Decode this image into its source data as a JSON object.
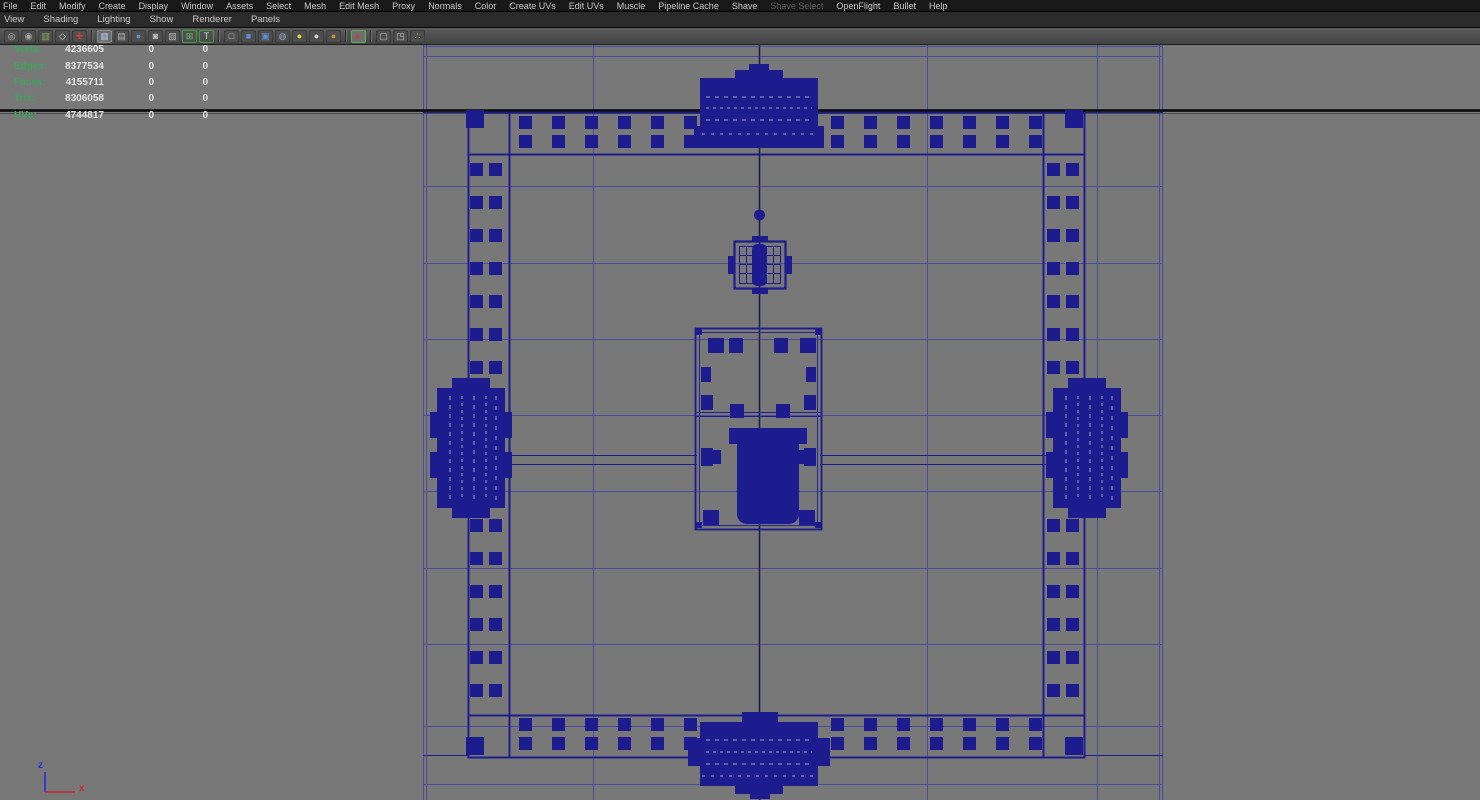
{
  "menu_bar": {
    "items": [
      {
        "label": "File",
        "enabled": true
      },
      {
        "label": "Edit",
        "enabled": true
      },
      {
        "label": "Modify",
        "enabled": true
      },
      {
        "label": "Create",
        "enabled": true
      },
      {
        "label": "Display",
        "enabled": true
      },
      {
        "label": "Window",
        "enabled": true
      },
      {
        "label": "Assets",
        "enabled": true
      },
      {
        "label": "Select",
        "enabled": true
      },
      {
        "label": "Mesh",
        "enabled": true
      },
      {
        "label": "Edit Mesh",
        "enabled": true
      },
      {
        "label": "Proxy",
        "enabled": true
      },
      {
        "label": "Normals",
        "enabled": true
      },
      {
        "label": "Color",
        "enabled": true
      },
      {
        "label": "Create UVs",
        "enabled": true
      },
      {
        "label": "Edit UVs",
        "enabled": true
      },
      {
        "label": "Muscle",
        "enabled": true
      },
      {
        "label": "Pipeline Cache",
        "enabled": true
      },
      {
        "label": "Shave",
        "enabled": true
      },
      {
        "label": "Shave Select",
        "enabled": false
      },
      {
        "label": "OpenFlight",
        "enabled": true
      },
      {
        "label": "Bullet",
        "enabled": true
      },
      {
        "label": "Help",
        "enabled": true
      }
    ]
  },
  "panel_menu": {
    "items": [
      {
        "label": "View"
      },
      {
        "label": "Shading"
      },
      {
        "label": "Lighting"
      },
      {
        "label": "Show"
      },
      {
        "label": "Renderer"
      },
      {
        "label": "Panels"
      }
    ]
  },
  "toolbar": {
    "groups": [
      {
        "icons": [
          {
            "name": "camera-icon",
            "glyph": "◎",
            "color": "#bcbcbc"
          },
          {
            "name": "camera-bookmark-icon",
            "glyph": "◉",
            "color": "#a8a8a8"
          },
          {
            "name": "bookmarks-icon",
            "glyph": "▥",
            "color": "#7fae5a"
          },
          {
            "name": "image-plane-icon",
            "glyph": "◇",
            "color": "#cfcfcf"
          },
          {
            "name": "grease-pencil-icon",
            "glyph": "✚",
            "color": "#d23b2f"
          }
        ]
      },
      {
        "icons": [
          {
            "name": "grid-icon",
            "glyph": "▦",
            "color": "#a6bcd9",
            "active": true
          },
          {
            "name": "film-gate-icon",
            "glyph": "▤",
            "color": "#b5b5b5"
          },
          {
            "name": "resolution-gate-icon",
            "glyph": "●",
            "color": "#5d8fd0"
          },
          {
            "name": "gate-mask-icon",
            "glyph": "◙",
            "color": "#c0c0c0"
          },
          {
            "name": "field-chart-icon",
            "glyph": "▨",
            "color": "#b5b5b5"
          },
          {
            "name": "safe-action-icon",
            "glyph": "⊞",
            "color": "#6fc06f",
            "border": "#3f9c3f"
          },
          {
            "name": "safe-title-icon",
            "glyph": "T",
            "color": "#d8d8d8",
            "border": "#3f9c3f"
          }
        ]
      },
      {
        "icons": [
          {
            "name": "wireframe-icon",
            "glyph": "□",
            "color": "#c2c2c2"
          },
          {
            "name": "smooth-shade-icon",
            "glyph": "■",
            "color": "#5d8fd0"
          },
          {
            "name": "wireframe-on-shaded-icon",
            "glyph": "▣",
            "color": "#5d8fd0"
          },
          {
            "name": "textured-icon",
            "glyph": "◍",
            "color": "#8fa3c0"
          },
          {
            "name": "use-all-lights-icon",
            "glyph": "●",
            "color": "#e3d435"
          },
          {
            "name": "default-light-icon",
            "glyph": "●",
            "color": "#d2d2d2"
          },
          {
            "name": "no-lights-icon",
            "glyph": "●",
            "color": "#c3922e"
          }
        ]
      },
      {
        "icons": [
          {
            "name": "isolate-select-icon",
            "glyph": "▸",
            "color": "#e03434",
            "border": "#58b058",
            "active": true
          }
        ]
      },
      {
        "icons": [
          {
            "name": "subdiv-cube-icon",
            "glyph": "▢",
            "color": "#c2c2c2"
          },
          {
            "name": "duplicate-panel-icon",
            "glyph": "◳",
            "color": "#c2c2c2"
          },
          {
            "name": "connections-icon",
            "glyph": "∴",
            "color": "#c2c2c2"
          }
        ]
      }
    ]
  },
  "hud": {
    "rows": [
      {
        "label": "Verts:",
        "v1": "4236605",
        "v2": "0",
        "v3": "0"
      },
      {
        "label": "Edges:",
        "v1": "8377534",
        "v2": "0",
        "v3": "0"
      },
      {
        "label": "Faces:",
        "v1": "4155711",
        "v2": "0",
        "v3": "0"
      },
      {
        "label": "Tris:",
        "v1": "8306058",
        "v2": "0",
        "v3": "0"
      },
      {
        "label": "UVs:",
        "v1": "4744817",
        "v2": "0",
        "v3": "0"
      }
    ]
  },
  "axis_gizmo": {
    "z_label": "z",
    "x_label": "x"
  },
  "colors": {
    "viewport_bg": "#787878",
    "wireframe": "#1c1c8f",
    "grid_line": "#4b4b9e",
    "axis_black": "#060608",
    "hud_green": "#3da45c",
    "gizmo_z_blue": "#2b2bdf",
    "gizmo_x_red": "#c42a2a"
  }
}
